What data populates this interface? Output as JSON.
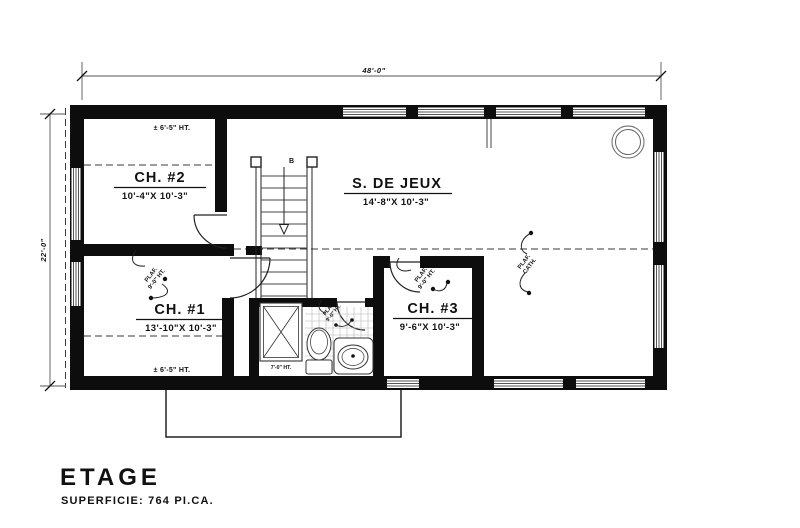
{
  "title": {
    "text": "ETAGE",
    "area": "SUPERFICIE: 764 PI.CA."
  },
  "dims": {
    "overall_width": "48'-0\"",
    "overall_depth": "22'-0\""
  },
  "rooms": {
    "ch2": {
      "label": "CH. #2",
      "size": "10'-4\"X 10'-3\""
    },
    "jeux": {
      "label": "S. DE JEUX",
      "size": "14'-8\"X 10'-3\""
    },
    "ch1": {
      "label": "CH. #1",
      "size": "13'-10\"X 10'-3\""
    },
    "ch3": {
      "label": "CH. #3",
      "size": "9'-6\"X 10'-3\""
    }
  },
  "annotations": {
    "eaves_height": "± 6'-5\" HT.",
    "plaf_line1": "PLAF.",
    "plaf_line2": "9'-0\" HT.",
    "cath_line1": "PLAF.",
    "cath_line2": "CATH.",
    "shower_height": "7'-0\" HT.",
    "stair_direction": "B"
  },
  "colors": {
    "wall": "#0d0d0d",
    "line": "#2b2b2b",
    "glazing": "#555555",
    "background": "#ffffff"
  }
}
